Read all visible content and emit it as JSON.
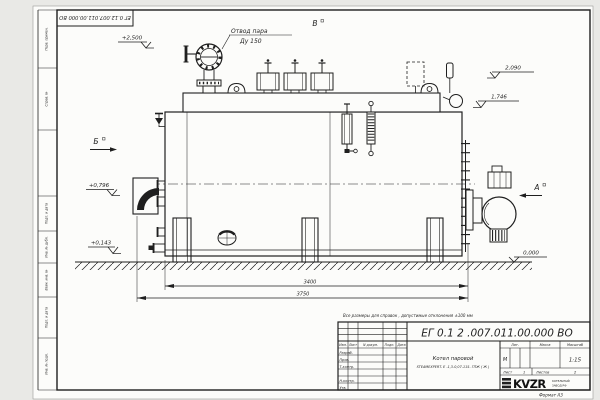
{
  "sheet": {
    "background": "#e9e9e6",
    "paper_color": "#fcfcfa",
    "line_color": "#1f1f1f",
    "note": "Все размеры для справок , допустимые отклонения  ±100 мм",
    "format_label": "Формат  А3",
    "top_stamp": "ЕГ 0.12.007.011.00.000  ВО"
  },
  "frame": {
    "side_labels": [
      "Перв. примен.",
      "Справ. №",
      "Подп. и дата",
      "Инв. № дубл.",
      "Взам. инв. №",
      "Подп. и дата",
      "Инв. № подл."
    ]
  },
  "title_block": {
    "doc_number": "ЕГ 0.1 2 .007.011.00.000   ВО",
    "product_line1": "Котел паровой",
    "product_line2": "STEAMEXPERT- Е -1,3-0,07-115- ГПЖ ( Ж )",
    "col_izm": "Изм.",
    "col_list": "Лист",
    "col_doc": "N докум.",
    "col_podp": "Подп.",
    "col_data": "Дата",
    "row_razrab": "Разраб.",
    "row_prov": "Пров.",
    "row_tkontr": "Т.контр.",
    "row_nkontr": "Н.контр.",
    "row_utv": "Утв.",
    "lit_label": "Лит.",
    "lit_value": "М",
    "mass_label": "Масса",
    "scale_label": "Масштаб",
    "scale_value": "1:15",
    "sheet_label": "Лист",
    "sheet_value": "1",
    "sheets_label": "Листов",
    "sheets_value": "2",
    "logo_text": "KVZR",
    "logo_line1": "КОТЕЛЬНЫЙ",
    "logo_line2": "ЗАВОД РФ"
  },
  "annotations": {
    "steam_outlet_line1": "Отвод пара",
    "steam_outlet_line2": "Ду 150",
    "view_b": "Б",
    "view_v": "В",
    "view_a": "А"
  },
  "elevations": {
    "top": "+2,500",
    "e2090": "2,090",
    "e1746": "1,746",
    "e0796": "+0,796",
    "e0143": "+0,143",
    "zero": "0,000"
  },
  "dimensions": {
    "shell_length": "3400",
    "overall_length": "3750"
  }
}
